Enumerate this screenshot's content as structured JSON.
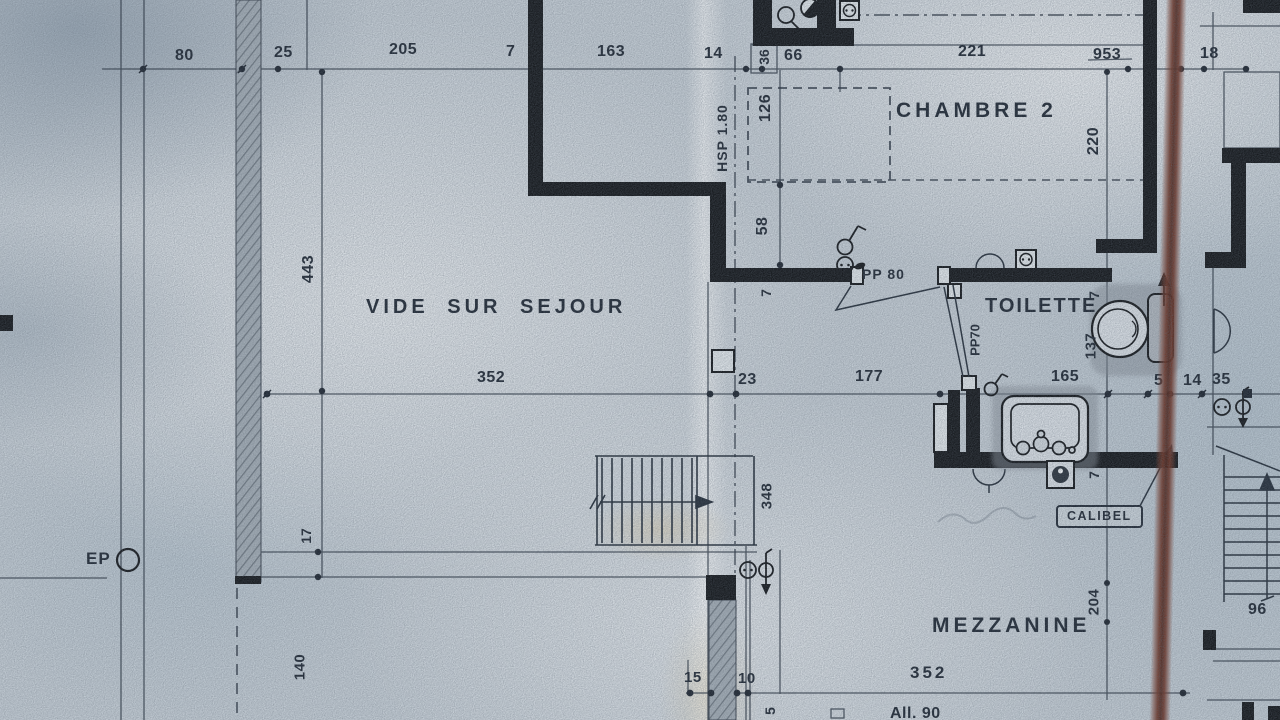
{
  "sheet": {
    "type": "scanned architectural floor plan",
    "colors": {
      "paper": "#c3ccd4",
      "ink": "#1f2834",
      "wall": "#14171b",
      "marker_line": "#5f2d20",
      "fixture_shadow": "#878f99"
    }
  },
  "rooms": {
    "vide_sur_sejour": "VIDE SUR SEJOUR",
    "chambre_2": "CHAMBRE 2",
    "toilette": "TOILETTE",
    "mezzanine": "MEZZANINE"
  },
  "doors": {
    "pp80": "PP 80",
    "pp70": "PP70"
  },
  "notes": {
    "hsp": "HSP 1.80",
    "calibel": "CALIBEL",
    "ep": "EP",
    "allege": "All. 90"
  },
  "dims": {
    "top": {
      "d80": "80",
      "d25": "25",
      "d205": "205",
      "d7": "7",
      "d163": "163",
      "d14": "14",
      "d36": "36",
      "d66": "66",
      "d221": "221",
      "d953": "953",
      "d18": "18"
    },
    "mid": {
      "d352": "352",
      "d23": "23",
      "d177": "177",
      "d165": "165",
      "d5": "5",
      "d14": "14",
      "d35": "35"
    },
    "vertical": {
      "d126": "126",
      "d220": "220",
      "d58": "58",
      "d7wall": "7",
      "d443": "443",
      "d7toil": "7",
      "d137": "137",
      "d7sink": "7",
      "d348": "348",
      "d17": "17",
      "d140": "140",
      "d204": "204",
      "d5part": "5"
    },
    "bottom": {
      "d15": "15",
      "d10": "10",
      "d352": "352",
      "d96": "96"
    }
  }
}
